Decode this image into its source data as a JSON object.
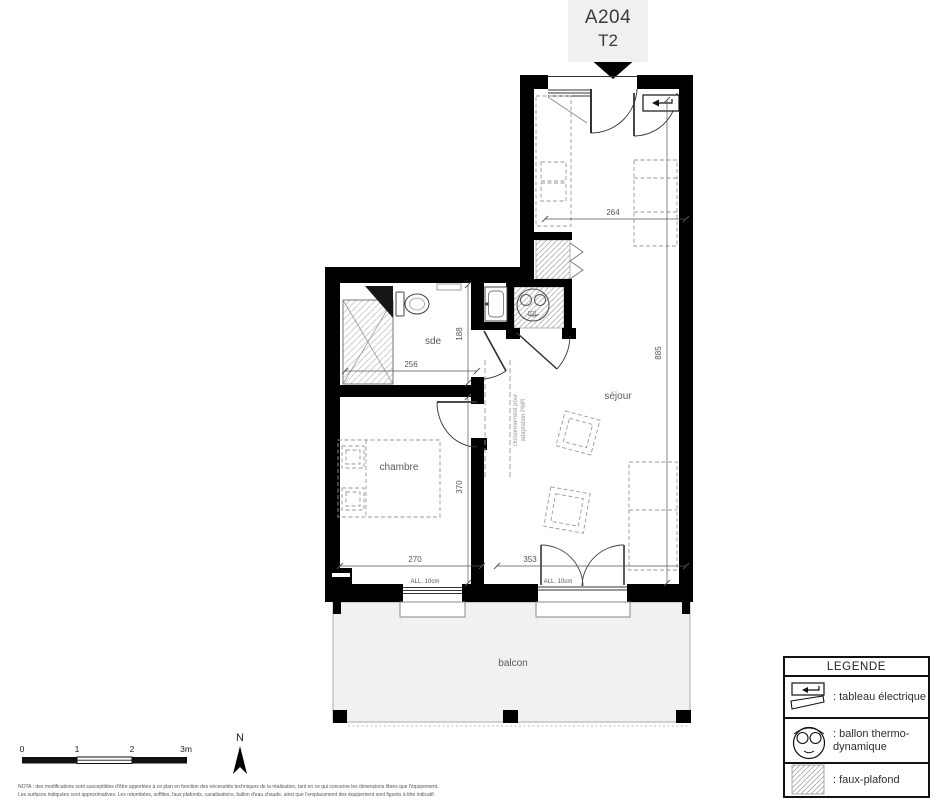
{
  "unit_label": {
    "code": "A204",
    "type": "T2"
  },
  "rooms": {
    "bathroom": "sde",
    "bedroom": "chambre",
    "living": "séjour",
    "balcony": "balcon",
    "storage": "rgt"
  },
  "dimensions": {
    "entry_width": "264",
    "living_height": "885",
    "bathroom_width": "256",
    "bathroom_depth": "188",
    "bedroom_depth": "370",
    "bedroom_width": "270",
    "living_width": "353",
    "sill_left": "ALL. 10cm",
    "sill_right": "ALL. 10cm"
  },
  "annotations": {
    "pmr_line1": "cloisonnement pour",
    "pmr_line2": "adaptation PMR"
  },
  "scale_bar": {
    "tick0": "0",
    "tick1": "1",
    "tick2": "2",
    "tick3": "3m"
  },
  "compass": {
    "north": "N"
  },
  "legend": {
    "title": "LEGENDE",
    "electrical": {
      "icon": "electrical-panel-icon",
      "label": ": tableau électrique"
    },
    "water_heater": {
      "icon": "water-heater-icon",
      "label_line1": ": ballon thermo-",
      "label_line2": "dynamique"
    },
    "false_ceiling": {
      "icon": "ceiling-hatch-icon",
      "label": ": faux-plafond"
    }
  },
  "nota": {
    "line1": "NOTA : des modifications sont susceptibles d'être apportées à ce plan en fonction des nécessités techniques de la réalisation, tant en ce qui concerne les dimensions libres que l'équipement.",
    "line2": "Les surfaces indiquées sont approximatives. Les retombées, soffites, faux plafonds, canalisations, ballon d'eau chaude, ainsi que l'emplacement des équipement sont figurés à titre indicatif."
  },
  "colors": {
    "wall": "#000000",
    "balcony_fill": "#f1f1f1",
    "unit_label_bg": "#f0f0f0",
    "dimension_text": "#555555"
  }
}
